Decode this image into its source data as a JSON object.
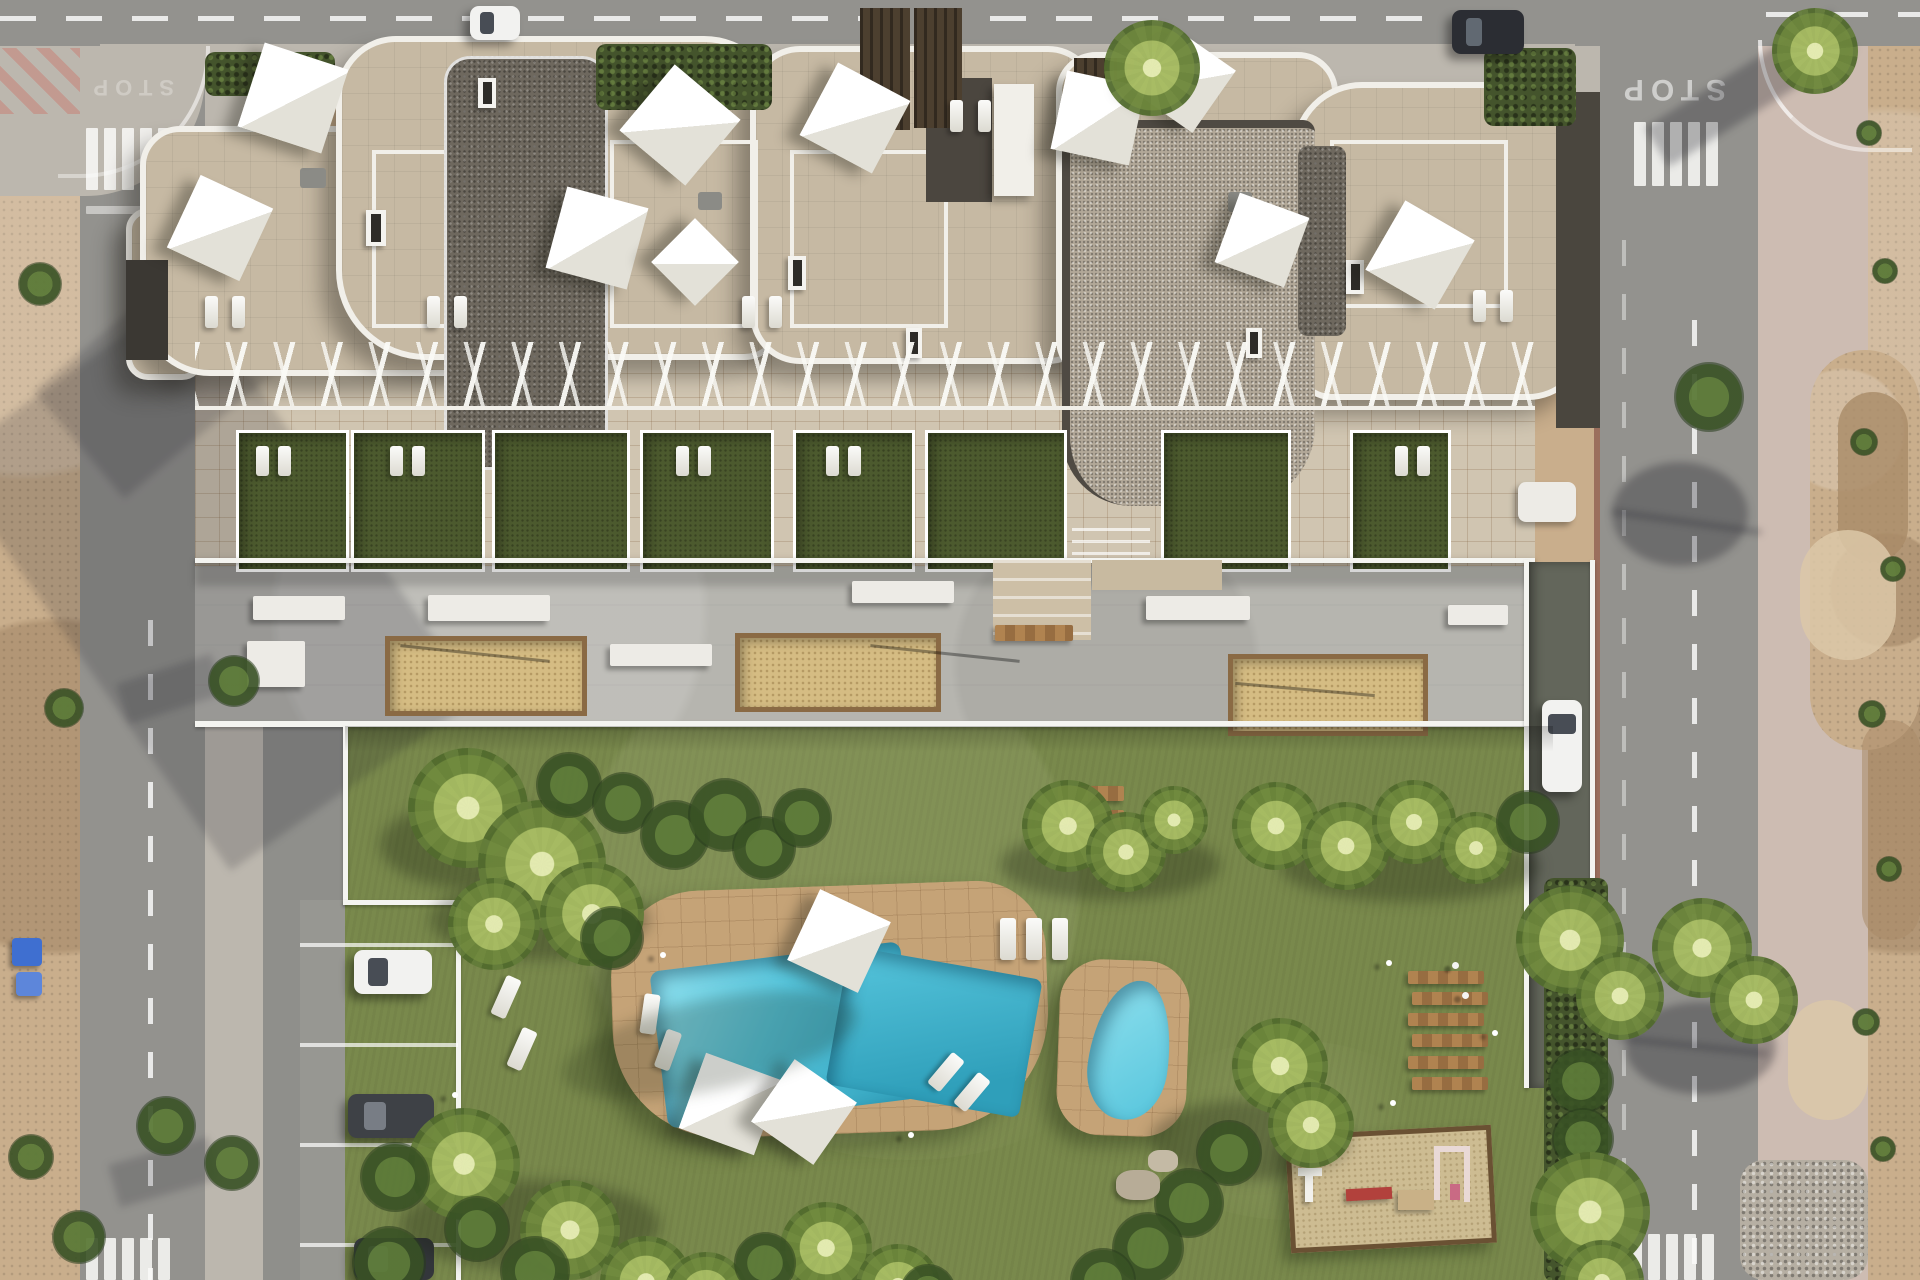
{
  "scene": {
    "title": "Aerial 3D render of a residential apartment complex with communal gardens and pools",
    "view": "top-down bird's-eye architectural visualization",
    "road_markings": {
      "stop_text": "STOP"
    },
    "palette": {
      "asphalt": "#93928e",
      "sidewalk": "#bcb7ae",
      "sidewalkPink": "#cdbcb2",
      "redPaving": "#b0584a",
      "dirt": "#c9ae8c",
      "dirtDark": "#a98b68",
      "dirtLight": "#dcc8a8",
      "rubble": "#b6afa3",
      "roofStone": "#c6b9a3",
      "roofStoneLight": "#d0c5b1",
      "gravelDark": "#6e685e",
      "gravelLight": "#b2a898",
      "parapet": "#f1efe9",
      "wallDark": "#3b3833",
      "terraceGreen": "#4c5a2e",
      "grass": "#79894c",
      "grassDark": "#5e7037",
      "grassLight": "#8d9e5b",
      "pool": "#56c5dc",
      "poolDark": "#2f9fba",
      "poolLight": "#8fe0ee",
      "deckTan": "#c5a377",
      "sandCourt": "#d5bc83",
      "wood": "#a87c4f",
      "benchWhite": "#edebe6",
      "carWhite": "#f2f2f0",
      "carDark": "#3e4146",
      "hedge": "#44542c",
      "binBlue": "#3f6fd0",
      "rampGray": "#63665b",
      "pergolaBrown": "#4c3f2f",
      "lineWhite": "#f4f4f0"
    },
    "objects": {
      "building": "white curvilinear apartment block with beige stone roof terraces and gravel roof patches",
      "roof_parasols": 10,
      "ground_floor_terrace_gardens": 8,
      "plaza_sand_courts": 3,
      "pools": [
        "main freeform pool",
        "children's pool"
      ],
      "pool_deck_parasols": 3,
      "sun_loungers_approx": 30,
      "wooden_sun_deck_rows": 6,
      "wooden_garden_steps": 3,
      "outdoor_gym": "sand pad with white, red and pink fitness equipment",
      "parked_cars": [
        "white car in bay",
        "dark car in bay",
        "dark car in bay",
        "white car on access ramp",
        "white car on top road",
        "dark car on top road"
      ],
      "parking_bay_lines": 4,
      "crosswalks": 4,
      "streets": [
        "top road",
        "left road",
        "right road"
      ],
      "vacant_lot": "sandy undeveloped plot along the right edge",
      "recycling_bins": "blue bins on left sandy verge"
    }
  }
}
